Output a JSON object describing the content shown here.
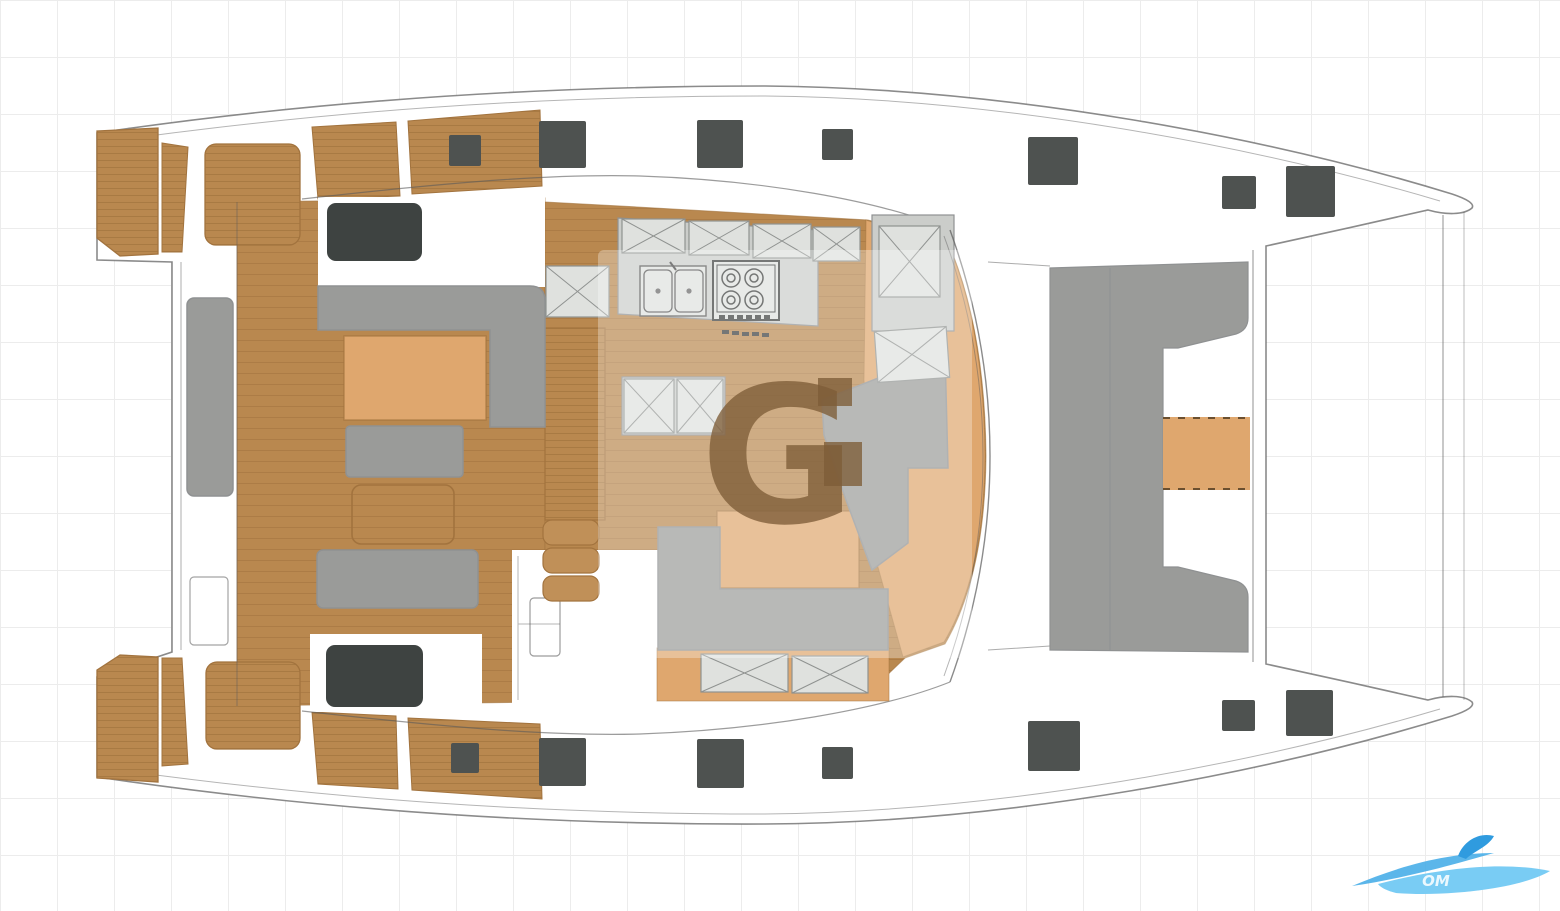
{
  "diagram": {
    "type": "catamaran-deck-floor-plan-top-view"
  },
  "watermark": {
    "letter": "G"
  },
  "logo": {
    "text": "OM"
  },
  "colors": {
    "grid": "#ececec",
    "outline": "#5a5a5a",
    "wood": "#b9884f",
    "wood_plank": "#a2733e",
    "wood_light": "#c09058",
    "orange": "#dfa76e",
    "counter": "#cbcdca",
    "counter_light": "#dfe1de",
    "seat_gray": "#9a9b99",
    "seat_gray_dark": "#8f9192",
    "hatch_dark": "#4e5250",
    "roof_hatch": "#3e4341",
    "watermark_brown": "rgba(126,92,55,0.78)",
    "watermark_box": "rgba(255,255,255,0.30)",
    "logo_blue": "#49aee8",
    "logo_blue_light": "#79ccf4",
    "logo_blue_dark": "#2f9bdf"
  },
  "deck_hatches": {
    "squares": [
      {
        "x": 449,
        "y": 135,
        "w": 32,
        "h": 31
      },
      {
        "x": 539,
        "y": 121,
        "w": 47,
        "h": 47
      },
      {
        "x": 697,
        "y": 120,
        "w": 46,
        "h": 48
      },
      {
        "x": 822,
        "y": 129,
        "w": 31,
        "h": 31
      },
      {
        "x": 1028,
        "y": 137,
        "w": 50,
        "h": 48
      },
      {
        "x": 1222,
        "y": 176,
        "w": 34,
        "h": 33
      },
      {
        "x": 1286,
        "y": 166,
        "w": 49,
        "h": 51
      },
      {
        "x": 451,
        "y": 743,
        "w": 28,
        "h": 30
      },
      {
        "x": 539,
        "y": 738,
        "w": 47,
        "h": 48
      },
      {
        "x": 697,
        "y": 739,
        "w": 47,
        "h": 49
      },
      {
        "x": 822,
        "y": 747,
        "w": 31,
        "h": 32
      },
      {
        "x": 1028,
        "y": 721,
        "w": 52,
        "h": 50
      },
      {
        "x": 1222,
        "y": 700,
        "w": 33,
        "h": 31
      },
      {
        "x": 1286,
        "y": 690,
        "w": 47,
        "h": 46
      }
    ],
    "roof": [
      {
        "x": 327,
        "y": 203,
        "w": 95,
        "h": 58
      },
      {
        "x": 326,
        "y": 645,
        "w": 97,
        "h": 62
      }
    ]
  },
  "x_lockers": [
    {
      "x": 622,
      "y": 219,
      "w": 63,
      "h": 34
    },
    {
      "x": 689,
      "y": 221,
      "w": 60,
      "h": 34
    },
    {
      "x": 753,
      "y": 224,
      "w": 58,
      "h": 34
    },
    {
      "x": 813,
      "y": 227,
      "w": 47,
      "h": 34
    },
    {
      "x": 546,
      "y": 266,
      "w": 63,
      "h": 51
    },
    {
      "x": 624,
      "y": 379,
      "w": 50,
      "h": 54
    },
    {
      "x": 677,
      "y": 379,
      "w": 46,
      "h": 54
    },
    {
      "x": 879,
      "y": 226,
      "w": 61,
      "h": 71
    },
    {
      "x": 876,
      "y": 329,
      "w": 72,
      "h": 51,
      "rot": -4
    },
    {
      "x": 701,
      "y": 654,
      "w": 87,
      "h": 38
    },
    {
      "x": 792,
      "y": 656,
      "w": 76,
      "h": 37
    }
  ]
}
